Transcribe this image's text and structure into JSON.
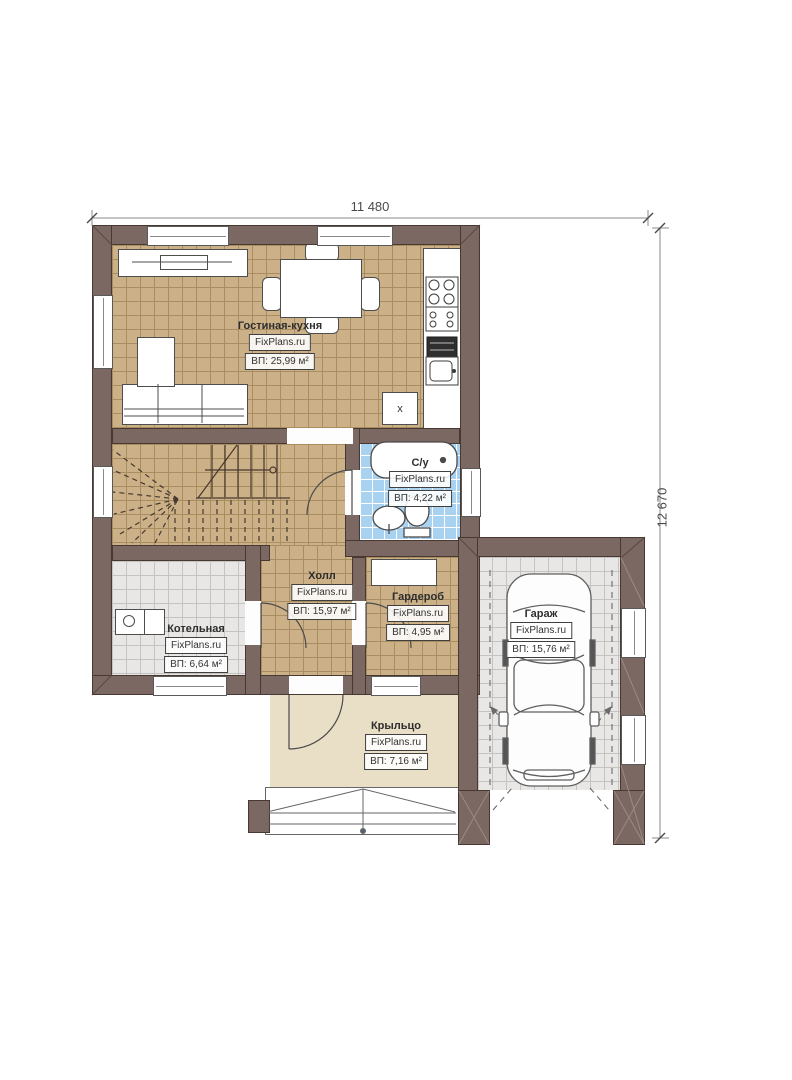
{
  "dimensions": {
    "width": "11 480",
    "height": "12 670"
  },
  "rooms": [
    {
      "name": "Гостиная-кухня",
      "brand": "FixPlans.ru",
      "area": "ВП: 25,99 м²"
    },
    {
      "name": "С/у",
      "brand": "FixPlans.ru",
      "area": "ВП: 4,22 м²"
    },
    {
      "name": "Холл",
      "brand": "FixPlans.ru",
      "area": "ВП: 15,97 м²"
    },
    {
      "name": "Гардероб",
      "brand": "FixPlans.ru",
      "area": "ВП: 4,95 м²"
    },
    {
      "name": "Котельная",
      "brand": "FixPlans.ru",
      "area": "ВП: 6,64 м²"
    },
    {
      "name": "Крыльцо",
      "brand": "FixPlans.ru",
      "area": "ВП: 7,16 м²"
    },
    {
      "name": "Гараж",
      "brand": "FixPlans.ru",
      "area": "ВП: 15,76 м²"
    }
  ],
  "annotations": {
    "kitchen_box_label": "x"
  },
  "colors": {
    "wall": "#7b6862",
    "floor_tan": "#ccb188",
    "floor_blue": "#a8d2ef",
    "floor_gray": "#e8e7e5",
    "porch": "#e9dec6"
  }
}
